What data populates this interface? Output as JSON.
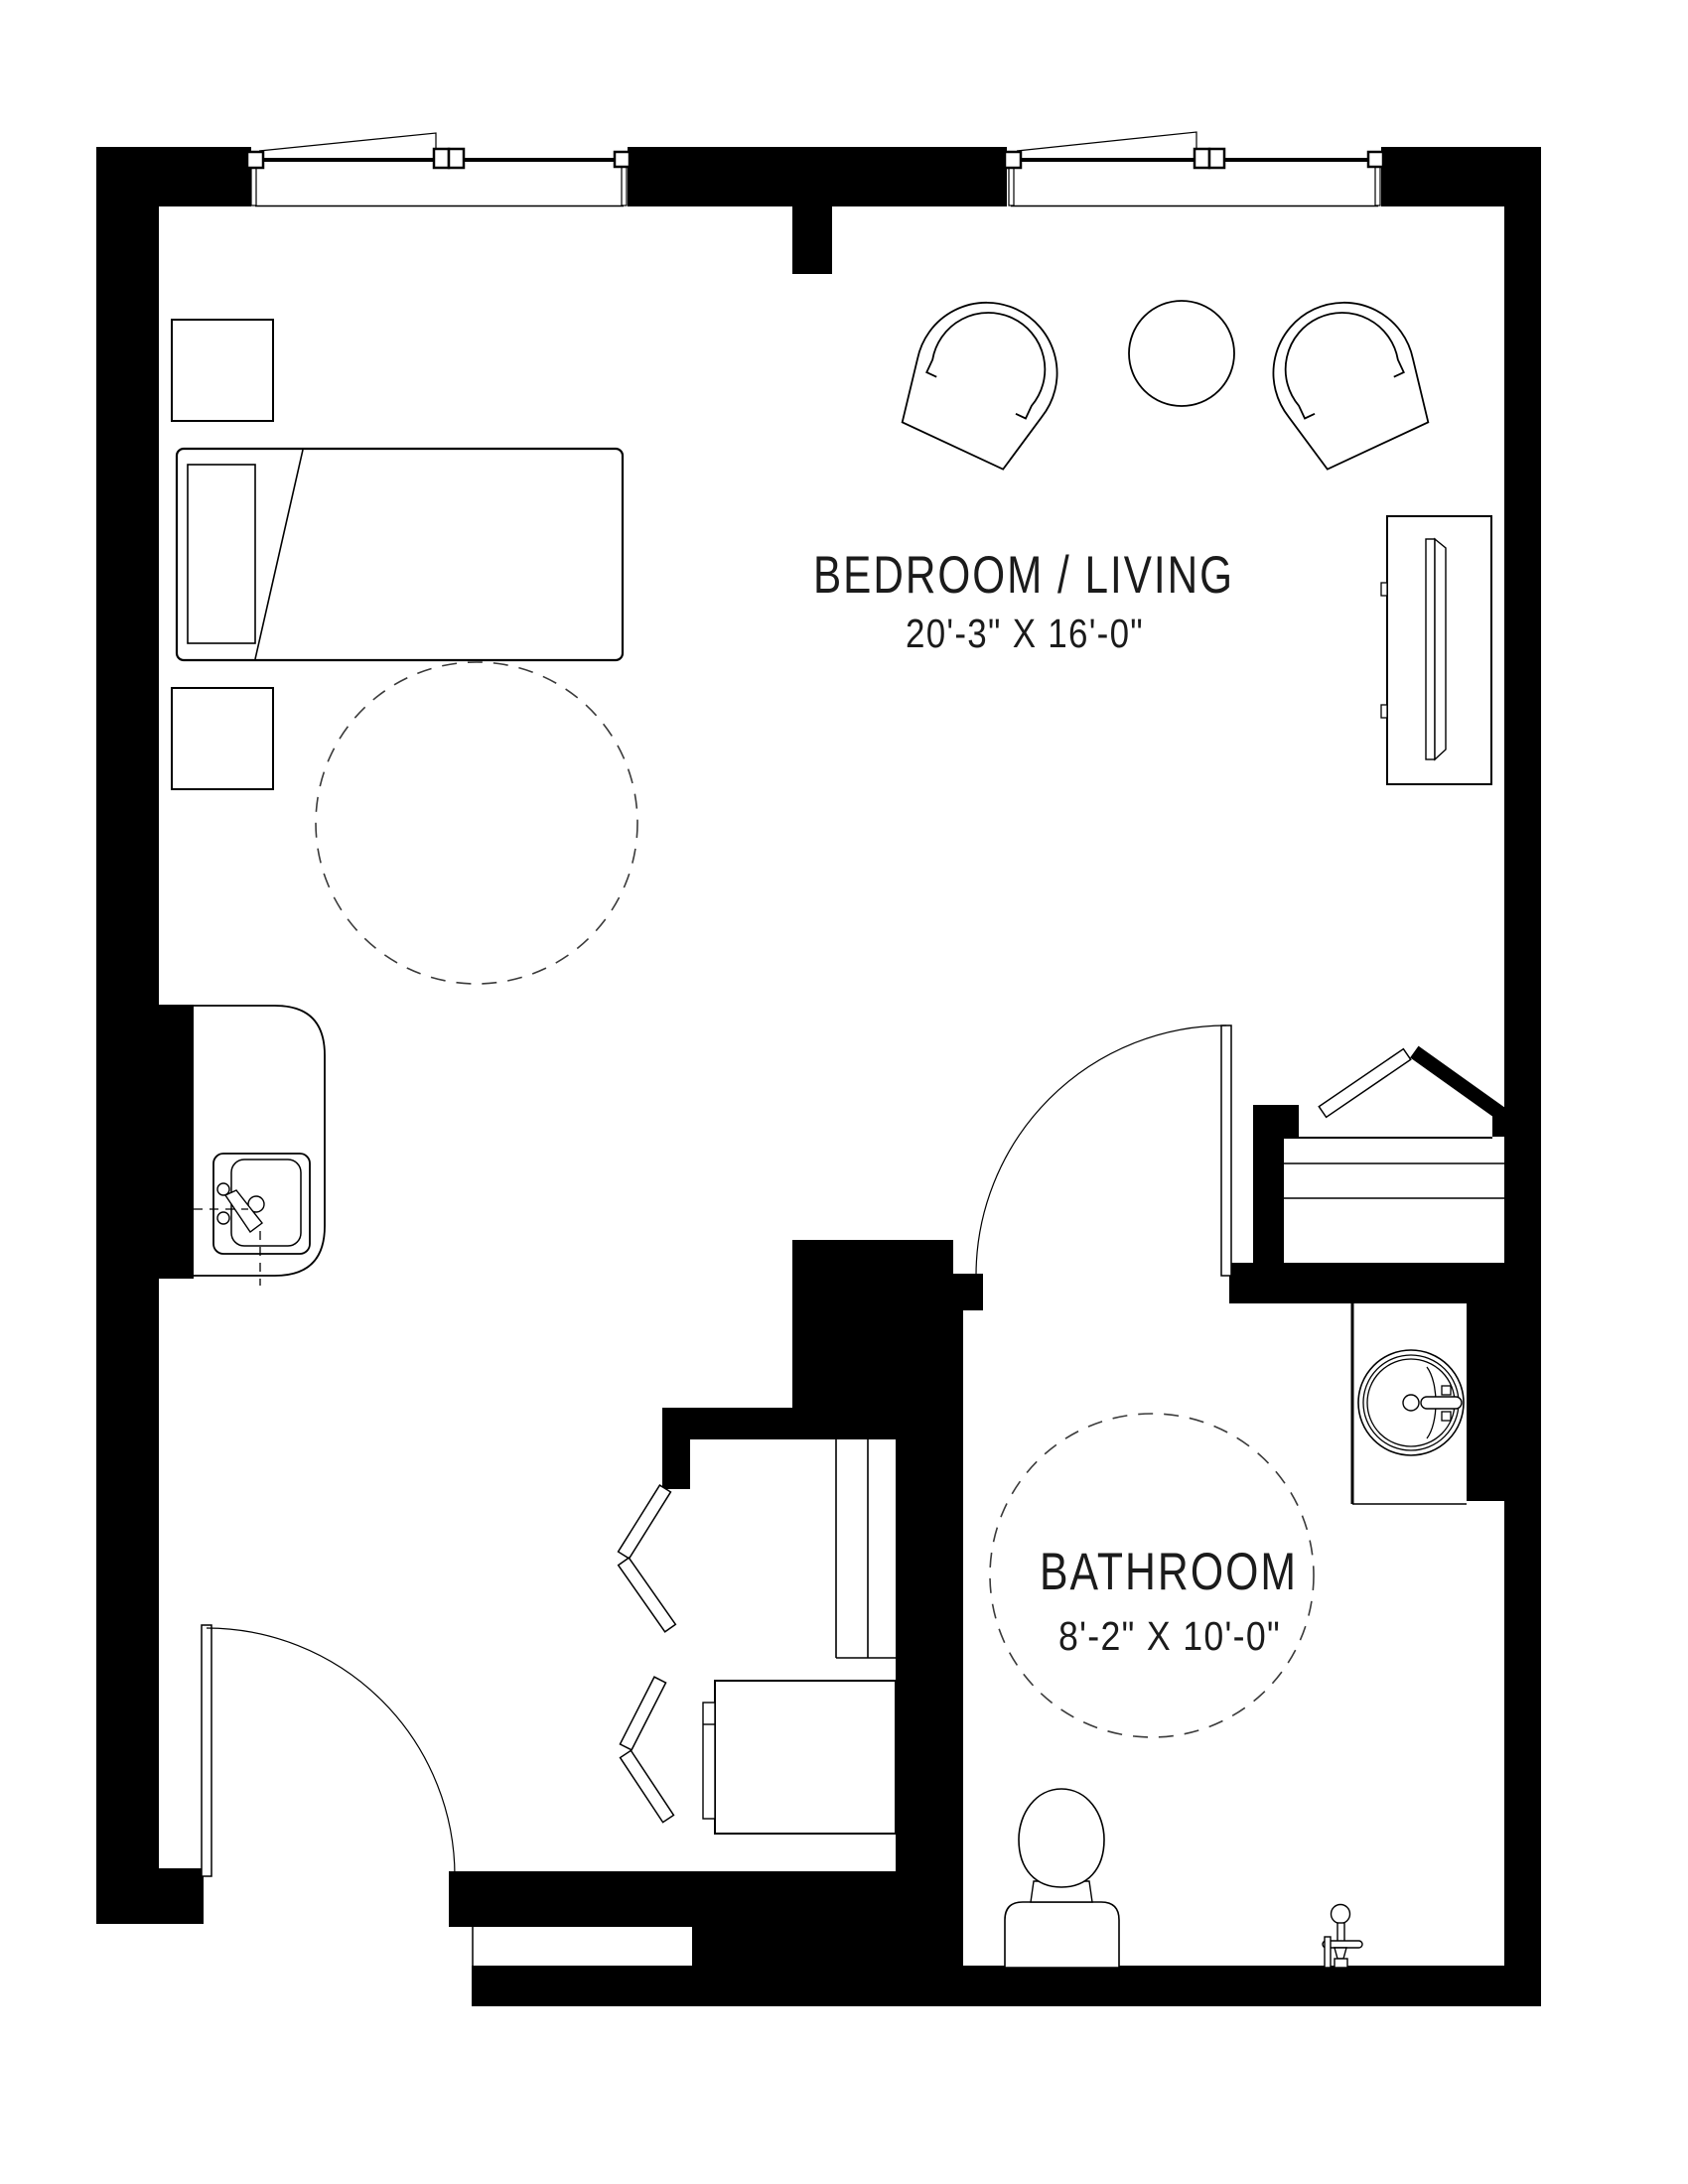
{
  "page": {
    "background": "#ffffff",
    "wall_color": "#000000",
    "line_color": "#000000",
    "text_color": "#1b1b1b"
  },
  "rooms": {
    "bedroom_living": {
      "name": "BEDROOM / LIVING",
      "dimensions": "20'-3\" X 16'-0\""
    },
    "bathroom": {
      "name": "BATHROOM",
      "dimensions": "8'-2\" X 10'-0\""
    }
  },
  "fixtures": {
    "bedroom_living": [
      "bed",
      "pillow",
      "nightstand",
      "lounge-chair",
      "round-side-table",
      "tv-console",
      "kitchenette-counter",
      "kitchen-sink",
      "turning-circle"
    ],
    "bathroom": [
      "round-vessel-sink",
      "vanity-counter",
      "toilet",
      "shower-valve",
      "turning-circle"
    ],
    "doors": [
      "entry-door",
      "bathroom-door",
      "bifold-closet-doors"
    ],
    "windows": [
      "window-left",
      "window-right"
    ]
  }
}
